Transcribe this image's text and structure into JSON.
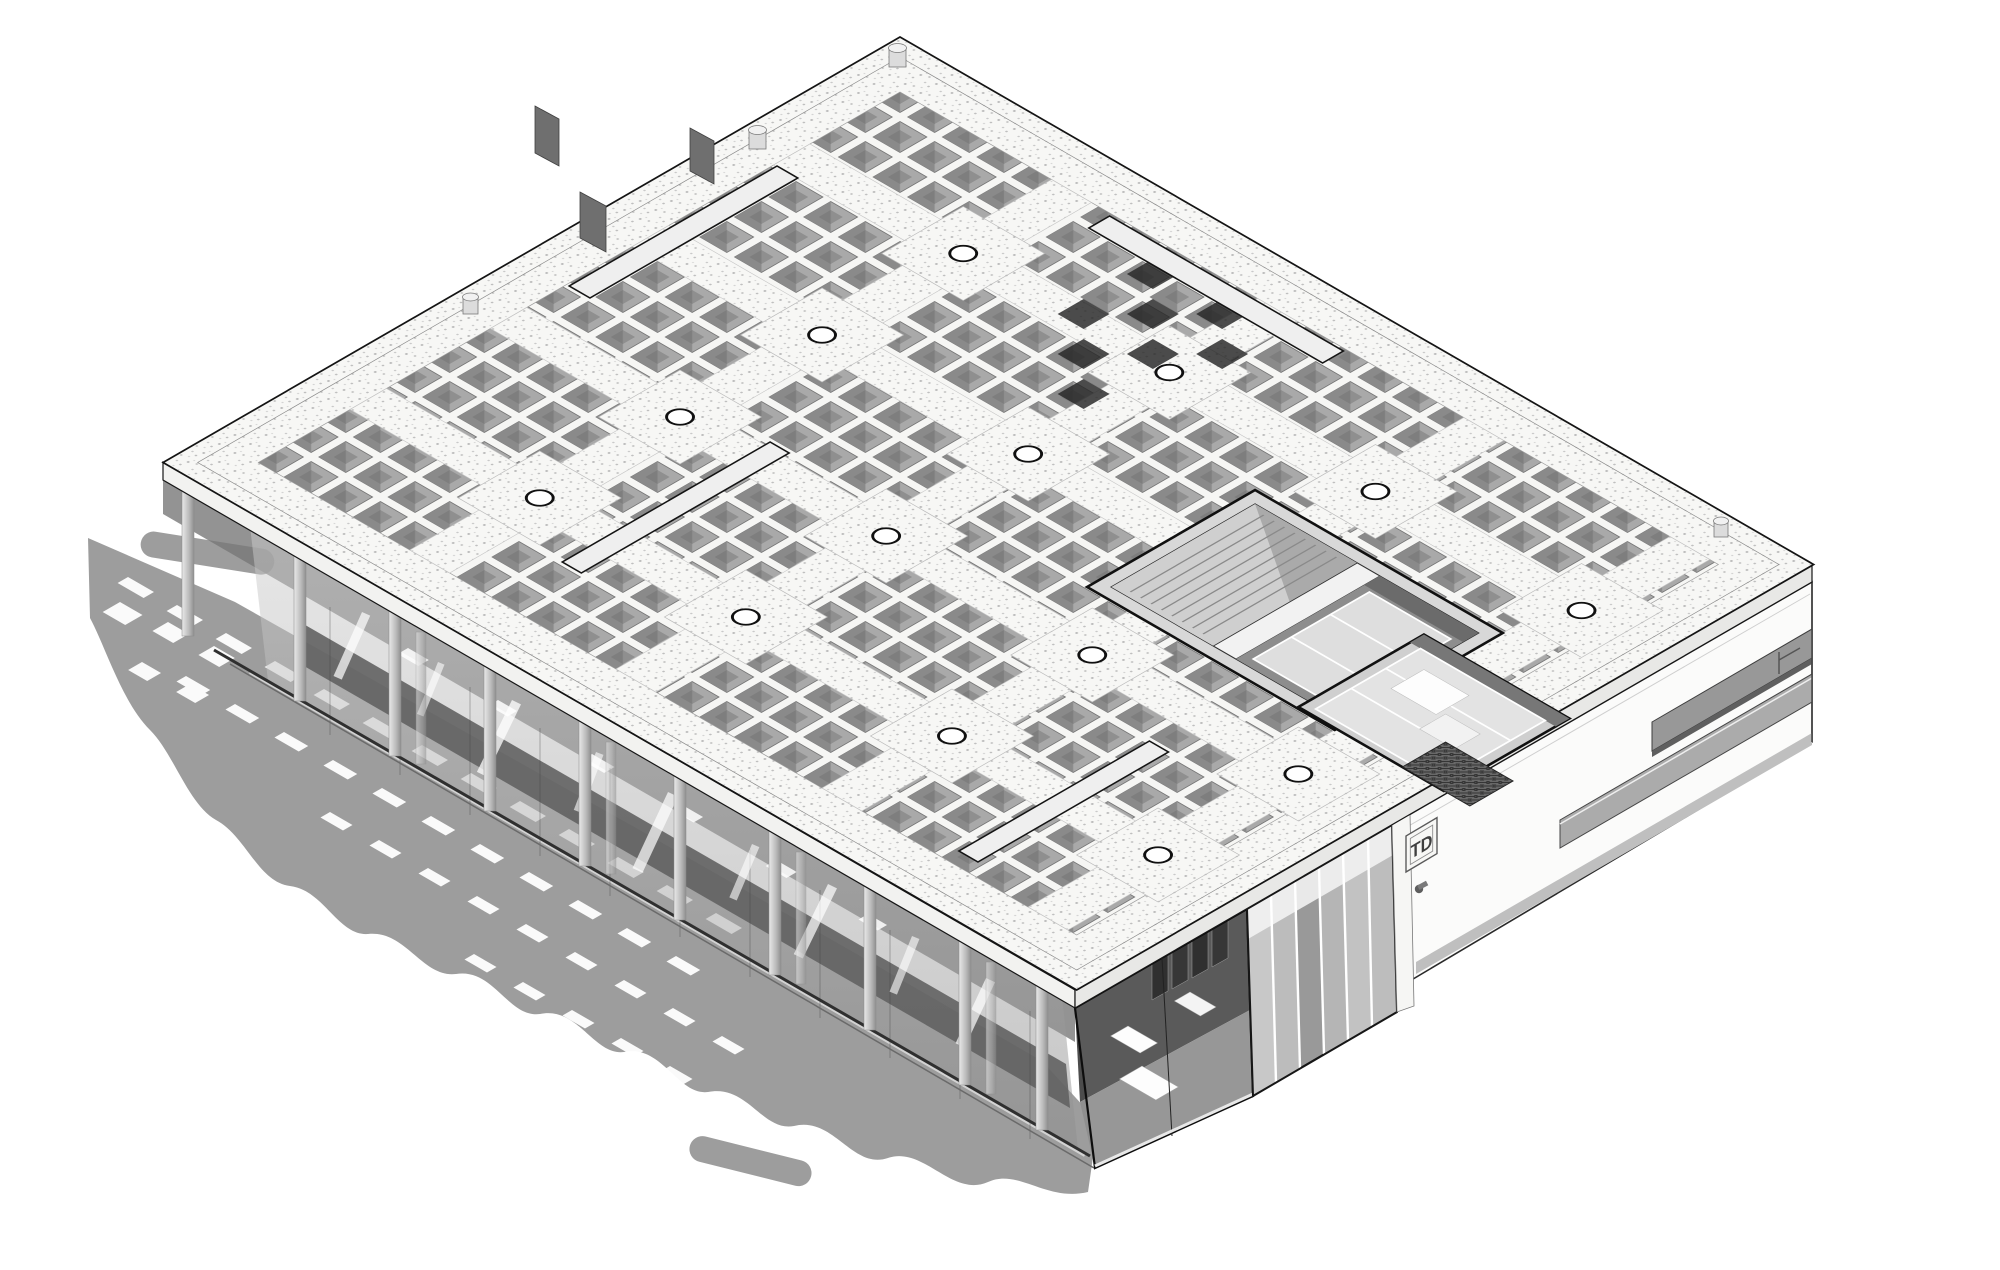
{
  "scene": {
    "type": "3d-axonometric-building-rendering",
    "style": "monochrome architectural BIM visualization",
    "subject": "single-storey pavilion with coffered waffle-slab roof, glazed colonnade ground floor, roof skylight courtyards and cast ground shadows"
  },
  "signage": {
    "entrance_plaque": "TD"
  },
  "palette": {
    "background": "#ffffff",
    "outline": "#141414",
    "roof_surface": "#f6f6f4",
    "coffer_grey": "#a6a6a6",
    "coffer_shadow": "#8a8a8a",
    "stipple_dot": "#bdbdbd",
    "ground_shadow": "#9d9d9d",
    "interior_dark": "#5c5c5c",
    "glass_grey": "#c6c6c6",
    "wall_white": "#fbfbfa"
  },
  "icons": {
    "roof_drain": "black ellipse outline",
    "wall_sconce": "dot with angled stem",
    "roof_vent": "cylinder stub",
    "parapet_fin": "grey rectangular fin"
  }
}
